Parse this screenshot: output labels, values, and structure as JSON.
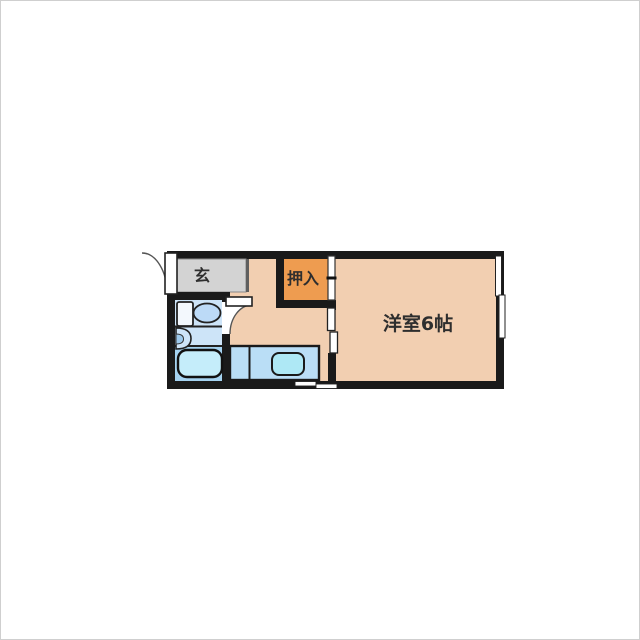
{
  "floor_plan": {
    "type": "japanese-apartment-floor-plan",
    "labels": {
      "entrance": "玄",
      "closet": "押入",
      "western_room": "洋室6帖"
    },
    "room_info": {
      "western_room_size": "6帖"
    },
    "colors": {
      "wall": "#1a1a1a",
      "floor_peach": "#f2cfb1",
      "closet_orange": "#ee9c50",
      "entrance_gray": "#d3d3d3",
      "bathroom_blue": "#cde4f8",
      "bath_area_blue": "#a5d3f1",
      "tub_fill": "#c5edfa",
      "toilet_bowl_fill": "#bcdaf7",
      "toilet_tank_fill": "#f3f8fd",
      "basin_inner_fill": "#9cc9ec",
      "counter_blue": "#badef6",
      "sink_cyan": "#aee8f5",
      "door_white": "#ffffff"
    },
    "fixtures": [
      "entrance-door",
      "toilet",
      "wash-basin",
      "bathtub",
      "bathroom-door",
      "kitchen-counter",
      "kitchen-sink",
      "closet-sliding-door",
      "room-sliding-door",
      "window-right-wall",
      "window-bottom-wall"
    ]
  }
}
